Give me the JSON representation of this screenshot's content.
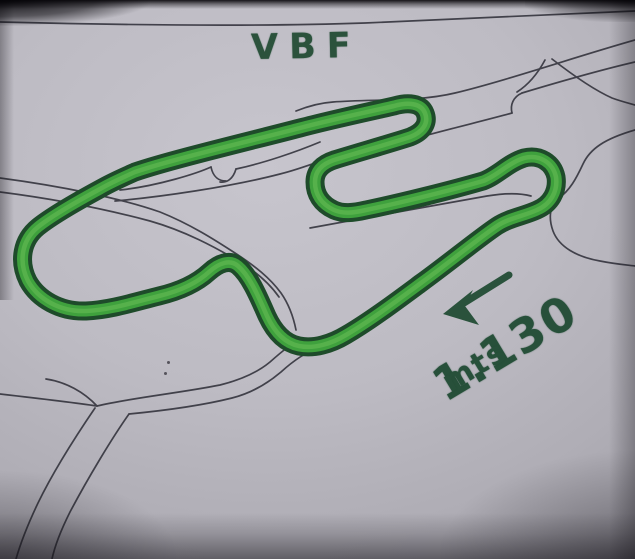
{
  "track": {
    "title": "VBF",
    "length_value": "1.130",
    "length_unit": "mts",
    "length_label": "1.130 mts",
    "arrow": "direction-arrow pointing lower-left along back straight",
    "colors": {
      "highlight_green": "#3fa13d",
      "outline_green": "#1e4b2a",
      "marker_ink": "#2a523c",
      "pen_line": "#30303a",
      "paper": "#bdbbc3"
    }
  }
}
